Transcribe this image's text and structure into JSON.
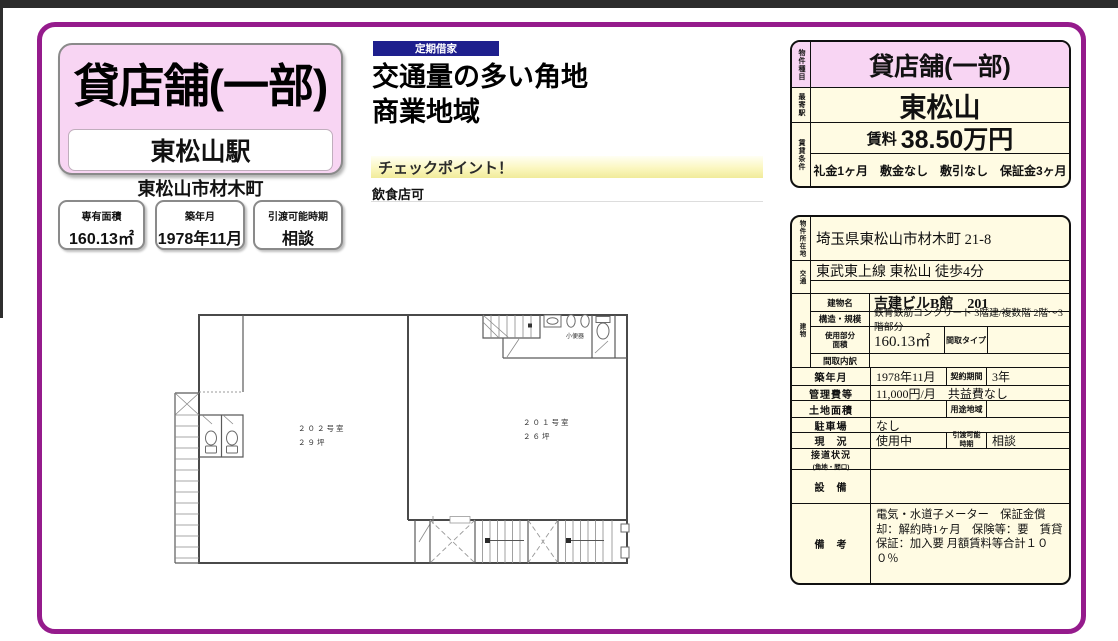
{
  "header": {
    "property_type": "貸店舗(一部)",
    "station": "東松山駅",
    "district": "東松山市材木町",
    "facts": [
      {
        "label": "専有面積",
        "value": "160.13㎡"
      },
      {
        "label": "築年月",
        "value": "1978年11月"
      },
      {
        "label": "引渡可能時期",
        "value": "相談"
      }
    ]
  },
  "highlight": {
    "badge": "定期借家",
    "line1": "交通量の多い角地",
    "line2": "商業地域",
    "checkpoint_title": "チェックポイント！",
    "checkpoint_body": "飲食店可"
  },
  "summary": {
    "row1_label": "物件種目",
    "row1_value": "貸店舗(一部)",
    "row2_label": "最寄駅",
    "row2_value": "東松山",
    "row3_label": "賃貸条件",
    "rent_label": "賃料",
    "rent_value": "38.50万円",
    "terms": "礼金1ヶ月　敷金なし　敷引なし　保証金3ヶ月"
  },
  "detail": {
    "address_label": "物件所在地",
    "address": "埼玉県東松山市材木町 21-8",
    "access_label": "交通",
    "access_line1": "東武東上線 東松山 徒歩4分",
    "access_line2": "",
    "building_label": "建物",
    "building_name_label": "建物名",
    "building_name": "吉建ビルB館　201",
    "structure_label": "構造・規模",
    "structure": "鉄骨鉄筋コンクリート 3階建/複数階 2階〜3階部分",
    "used_area_label": "使用部分面積",
    "used_area": "160.13㎡",
    "layout_type_label": "間取タイプ",
    "layout_type": "",
    "layout_detail_label": "間取内訳",
    "layout_detail": "",
    "built_label": "築年月",
    "built": "1978年11月",
    "contract_label": "契約期間",
    "contract": "3年",
    "mgmt_label": "管理費等",
    "mgmt": "11,000円/月　共益費なし",
    "land_label": "土地面積",
    "land": "",
    "zoning_label": "用途地域",
    "zoning": "",
    "parking_label": "駐車場",
    "parking": "なし",
    "status_label": "現　況",
    "status": "使用中",
    "handover_label": "引渡可能時期",
    "handover": "相談",
    "road_label": "接道状況",
    "road_sublabel": "(角地・間口)",
    "road": "",
    "equipment_label": "設　備",
    "equipment": "",
    "remarks_label": "備　考",
    "remarks": "電気・水道子メーター　保証金償却：解約時1ヶ月　保険等：要　賃貸保証：加入要 月額賃料等合計１００％"
  },
  "floor_plan": {
    "room_202_name": "２０２号室",
    "room_202_area": "２９坪",
    "room_201_name": "２０１号室",
    "room_201_area": "２６坪",
    "urinal_label": "小便器"
  },
  "colors": {
    "accent_purple": "#951b8c",
    "pink": "#f8d5f3",
    "cream": "#fffbe3",
    "navy": "#1e1f8d",
    "checkpoint_yellow": "#f1eb9a",
    "top_bar": "#2c2c2c"
  }
}
